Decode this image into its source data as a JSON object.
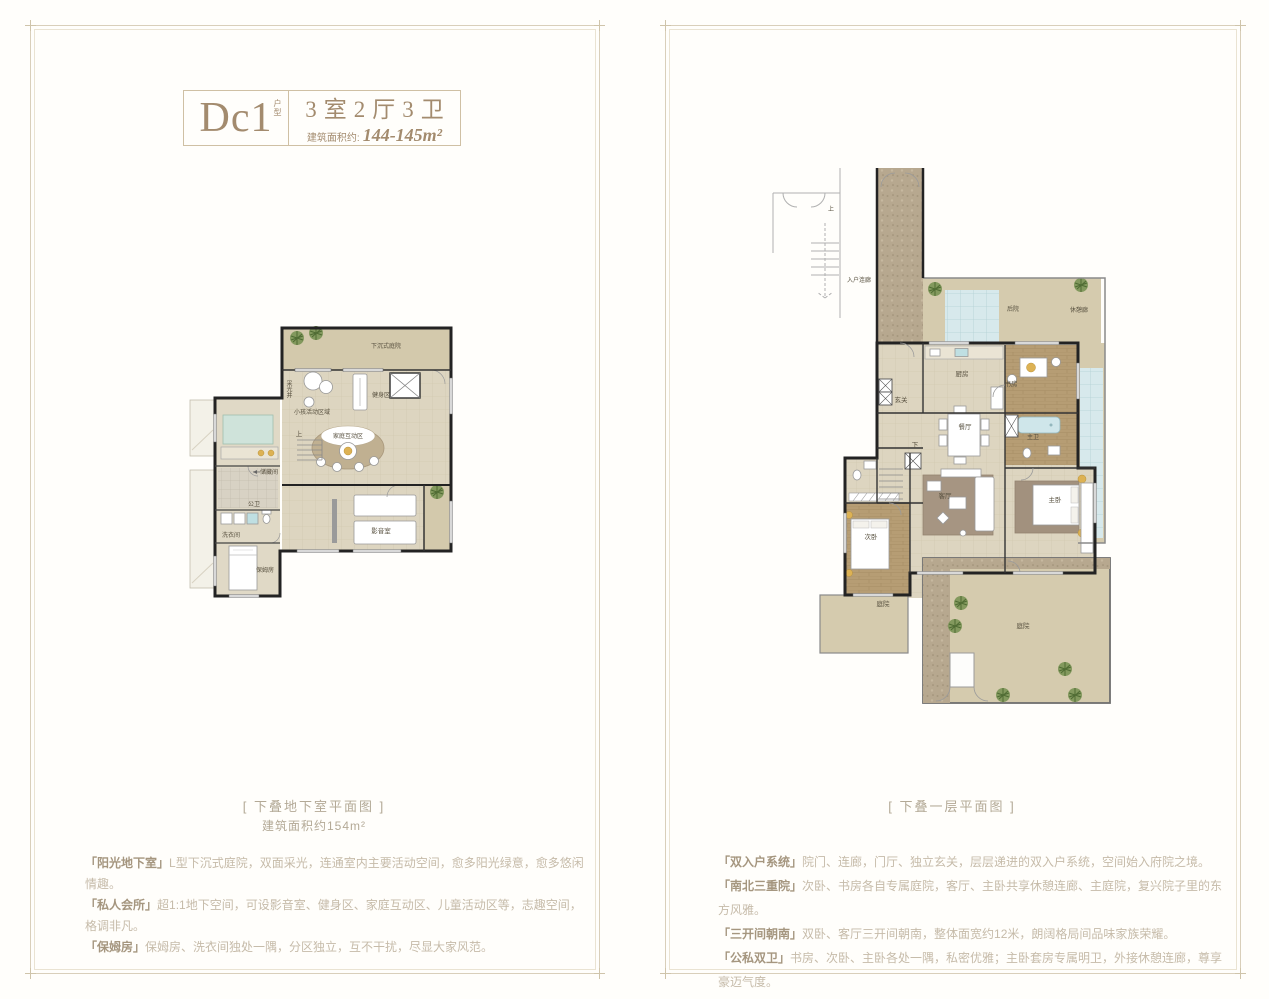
{
  "title": {
    "code": "Dc1",
    "code_suffix": "户型",
    "rooms": "3室2厅3卫",
    "area_label": "建筑面积约:",
    "area_value": "144-145m²"
  },
  "left_panel": {
    "caption": "[ 下叠地下室平面图 ]",
    "caption_sub": "建筑面积约154m²",
    "features": [
      {
        "tag": "「阳光地下室」",
        "text": "L型下沉式庭院，双面采光，连通室内主要活动空间，愈多阳光绿意，愈多悠闲情趣。"
      },
      {
        "tag": "「私人会所」",
        "text": "超1:1地下空间，可设影音室、健身区、家庭互动区、儿童活动区等，志趣空间，格调非凡。"
      },
      {
        "tag": "「保姆房」",
        "text": "保姆房、洗衣间独处一隅，分区独立，互不干扰，尽显大家风范。"
      }
    ]
  },
  "right_panel": {
    "caption": "[ 下叠一层平面图 ]",
    "features": [
      {
        "tag": "「双入户系统」",
        "text": "院门、连廊，门厅、独立玄关，层层递进的双入户系统，空间始入府院之境。"
      },
      {
        "tag": "「南北三重院」",
        "text": "次卧、书房各自专属庭院，客厅、主卧共享休憩连廊、主庭院，复兴院子里的东方风雅。"
      },
      {
        "tag": "「三开间朝南」",
        "text": "双卧、客厅三开间朝南，整体面宽约12米，朗阔格局间品味家族荣耀。"
      },
      {
        "tag": "「公私双卫」",
        "text": "书房、次卧、主卧各处一隅，私密优雅；主卧套房专属明卫，外接休憩连廊，尊享豪迈气度。"
      }
    ]
  },
  "left_plan": {
    "labels": {
      "sunken_courtyard": "下沉式庭院",
      "gym": "健身区",
      "kids": "小孩活动区域",
      "family": "家庭互动区",
      "storage": "储藏间",
      "bath": "公卫",
      "laundry": "洗衣间",
      "nanny": "保姆房",
      "cinema": "影音室",
      "lightwell": "采光井",
      "stairs_up": "上"
    }
  },
  "right_plan": {
    "labels": {
      "entry_corridor": "入户连廊",
      "backyard": "后院",
      "rest_corridor": "休憩廊",
      "kitchen": "厨房",
      "study": "书房",
      "foyer": "玄关",
      "dining": "餐厅",
      "master_bath": "主卫",
      "living": "客厅",
      "master_bed": "主卧",
      "second_bed": "次卧",
      "courtyard_small": "庭院",
      "courtyard_main": "庭院",
      "stairs_up": "上",
      "stairs_down": "下"
    },
    "colors": {
      "accent_gold": "#ddb254",
      "floor_beige": "#d5cbae",
      "glass_teal": "#d7e9ec"
    }
  }
}
